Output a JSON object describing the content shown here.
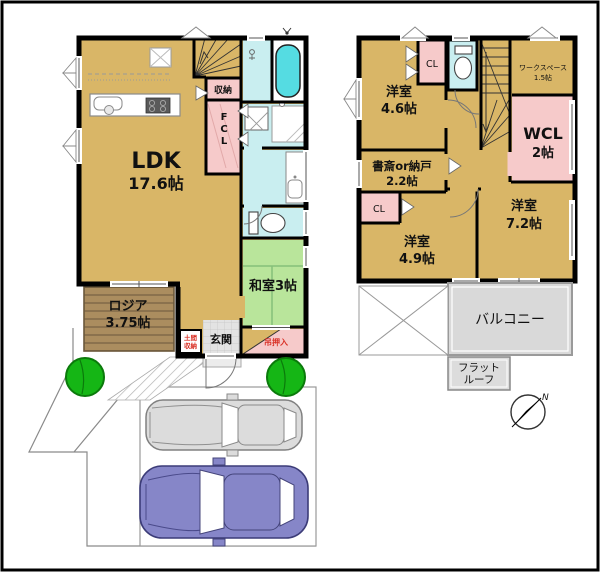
{
  "palette": {
    "room_tan": "#d9b667",
    "closet_pink": "#f6caca",
    "wet_area_teal": "#c9eef0",
    "bathtub_cyan": "#55dce2",
    "tatami_green": "#b9e59b",
    "entry_tile_gray": "#e0e0e0",
    "loggia_brown": "#ab8d5f",
    "balcony_gray": "#d9d9d9",
    "tree_green": "#15b615",
    "car_gray": "#dcdcdc",
    "car_blue": "#8686c8",
    "wall_black": "#000000",
    "red_label_text": "#d93025"
  },
  "floor1": {
    "ldk_name": "LDK",
    "ldk_size": "17.6帖",
    "storage": "収納",
    "fcl": "FCL",
    "washitsu": "和室3帖",
    "loggia_name": "ロジア",
    "loggia_size": "3.75帖",
    "genkan": "玄関",
    "doma_line1": "土間",
    "doma_line2": "収納",
    "tsurioshiire": "吊押入"
  },
  "floor2": {
    "bedroom1_name": "洋室",
    "bedroom1_size": "4.6帖",
    "cl1": "CL",
    "workspace_name": "ワークスペース",
    "workspace_size": "1.5帖",
    "wcl_name": "WCL",
    "wcl_size": "2帖",
    "study_name": "書斎or納戸",
    "study_size": "2.2帖",
    "cl2": "CL",
    "bedroom2_name": "洋室",
    "bedroom2_size": "4.9帖",
    "bedroom3_name": "洋室",
    "bedroom3_size": "7.2帖",
    "balcony": "バルコニー",
    "flatroof_line1": "フラット",
    "flatroof_line2": "ルーフ"
  },
  "compass": {
    "north_label": "N"
  }
}
